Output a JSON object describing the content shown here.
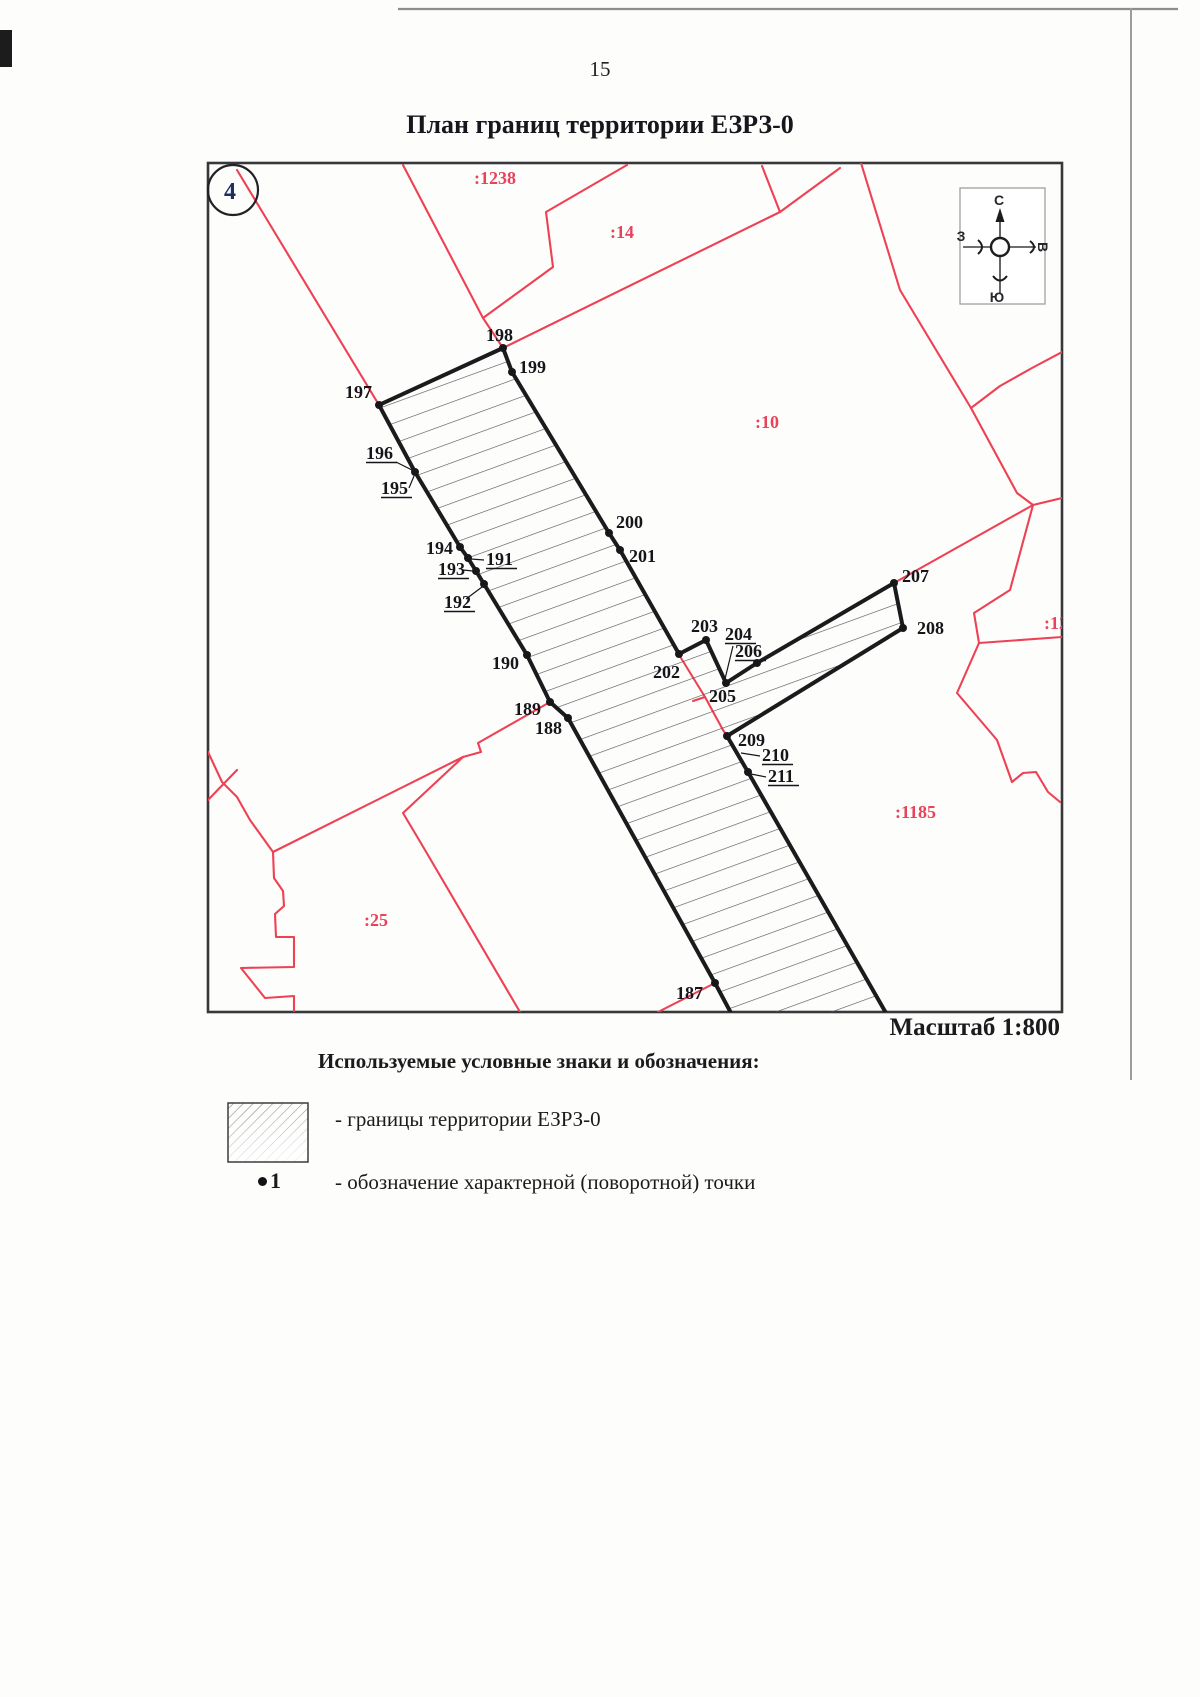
{
  "page": {
    "number": "15",
    "title": "План границ территории ЕЗРЗ-0",
    "sheet_badge": "4"
  },
  "map": {
    "scale_label": "Масштаб 1:800",
    "compass": {
      "north": "С",
      "south": "Ю",
      "west": "З",
      "east": "В"
    },
    "parcel_labels": [
      {
        "text": ":1238",
        "x": 474,
        "y": 184
      },
      {
        "text": ":14",
        "x": 610,
        "y": 238
      },
      {
        "text": ":10",
        "x": 755,
        "y": 428
      },
      {
        "text": ":12",
        "x": 1044,
        "y": 629
      },
      {
        "text": ":1185",
        "x": 895,
        "y": 818
      },
      {
        "text": ":25",
        "x": 364,
        "y": 926
      }
    ],
    "points": [
      {
        "n": "187",
        "dot": [
          715,
          983
        ],
        "label": [
          676,
          999
        ],
        "u": false,
        "leader": null
      },
      {
        "n": "188",
        "dot": [
          568,
          718
        ],
        "label": [
          535,
          734
        ],
        "u": false,
        "leader": null
      },
      {
        "n": "189",
        "dot": [
          550,
          702
        ],
        "label": [
          514,
          715
        ],
        "u": false,
        "leader": null
      },
      {
        "n": "190",
        "dot": [
          527,
          655
        ],
        "label": [
          492,
          669
        ],
        "u": false,
        "leader": null
      },
      {
        "n": "191",
        "dot": [
          468,
          558
        ],
        "label": [
          486,
          565
        ],
        "u": true,
        "leader": [
          484,
          560,
          471,
          559
        ]
      },
      {
        "n": "192",
        "dot": [
          484,
          584
        ],
        "label": [
          444,
          608
        ],
        "u": true,
        "leader": [
          466,
          599,
          482,
          587
        ]
      },
      {
        "n": "193",
        "dot": [
          476,
          571
        ],
        "label": [
          438,
          575
        ],
        "u": true,
        "leader": [
          463,
          570,
          473,
          571
        ]
      },
      {
        "n": "194",
        "dot": [
          460,
          547
        ],
        "label": [
          426,
          554
        ],
        "u": false,
        "leader": null
      },
      {
        "n": "195",
        "dot": [
          415,
          472
        ],
        "label": [
          381,
          494
        ],
        "u": true,
        "leader": [
          409,
          488,
          414,
          476
        ]
      },
      {
        "n": "196",
        "dot": null,
        "label": [
          366,
          459
        ],
        "u": true,
        "leader": [
          396,
          462,
          412,
          470
        ]
      },
      {
        "n": "197",
        "dot": [
          379,
          405
        ],
        "label": [
          345,
          398
        ],
        "u": false,
        "leader": null
      },
      {
        "n": "198",
        "dot": [
          503,
          348
        ],
        "label": [
          486,
          341
        ],
        "u": false,
        "leader": null
      },
      {
        "n": "199",
        "dot": [
          512,
          372
        ],
        "label": [
          519,
          373
        ],
        "u": false,
        "leader": null
      },
      {
        "n": "200",
        "dot": [
          609,
          533
        ],
        "label": [
          616,
          528
        ],
        "u": false,
        "leader": null
      },
      {
        "n": "201",
        "dot": [
          620,
          550
        ],
        "label": [
          629,
          562
        ],
        "u": false,
        "leader": null
      },
      {
        "n": "202",
        "dot": [
          679,
          654
        ],
        "label": [
          653,
          678
        ],
        "u": false,
        "leader": null
      },
      {
        "n": "203",
        "dot": [
          706,
          640
        ],
        "label": [
          691,
          632
        ],
        "u": false,
        "leader": null
      },
      {
        "n": "204",
        "dot": null,
        "label": [
          725,
          640
        ],
        "u": true,
        "leader": [
          733,
          646,
          725,
          679
        ]
      },
      {
        "n": "205",
        "dot": [
          726,
          683
        ],
        "label": [
          709,
          702
        ],
        "u": false,
        "leader": null
      },
      {
        "n": "206",
        "dot": [
          757,
          663
        ],
        "label": [
          735,
          657
        ],
        "u": true,
        "leader": [
          754,
          661,
          757,
          664
        ]
      },
      {
        "n": "207",
        "dot": [
          894,
          583
        ],
        "label": [
          902,
          582
        ],
        "u": false,
        "leader": null
      },
      {
        "n": "208",
        "dot": [
          903,
          628
        ],
        "label": [
          917,
          634
        ],
        "u": false,
        "leader": null
      },
      {
        "n": "209",
        "dot": [
          727,
          736
        ],
        "label": [
          738,
          746
        ],
        "u": false,
        "leader": null
      },
      {
        "n": "210",
        "dot": null,
        "label": [
          762,
          761
        ],
        "u": true,
        "leader": [
          760,
          756,
          741,
          753
        ]
      },
      {
        "n": "211",
        "dot": [
          748,
          772
        ],
        "label": [
          768,
          782
        ],
        "u": true,
        "leader": [
          766,
          777,
          751,
          774
        ]
      }
    ]
  },
  "legend": {
    "heading": "Используемые условные знаки и обозначения:",
    "items": [
      {
        "symbol": "hatch-swatch",
        "text": "- границы территории ЕЗРЗ-0"
      },
      {
        "symbol": "turn-point",
        "sample": "1",
        "text": "- обозначение характерной (поворотной) точки"
      }
    ]
  },
  "colors": {
    "boundary_red": "#ee4153",
    "ink": "#1b1b1d"
  }
}
